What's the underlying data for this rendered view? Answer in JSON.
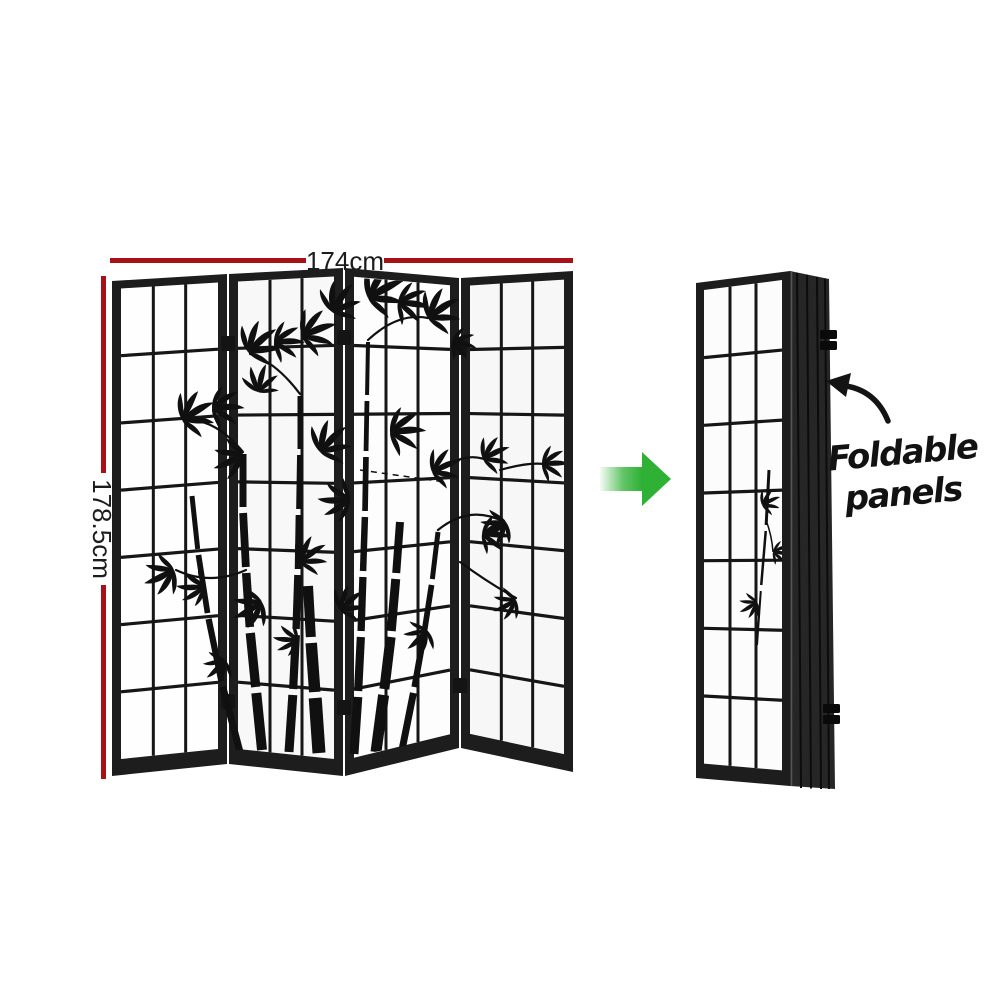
{
  "dimensions": {
    "width_label": "174cm",
    "height_label": "178.5cm"
  },
  "annotations": {
    "foldable_line1": "Foldable",
    "foldable_line2": "panels"
  },
  "views": {
    "front": {
      "label": "4 panel shoji room divider with black bamboo print, zigzag standing",
      "panel_count": 4,
      "grid_columns_per_panel": 3,
      "grid_rows_per_panel": 7
    },
    "folded": {
      "label": "room divider folded flat into a stack, side view",
      "panel_count": 4
    }
  },
  "colors": {
    "dimension_red": "#a81117",
    "arrow_green": "#2eb135",
    "frame_black": "#1d1d1d",
    "paper_white": "#fdfdfd",
    "ink_black": "#101010"
  }
}
